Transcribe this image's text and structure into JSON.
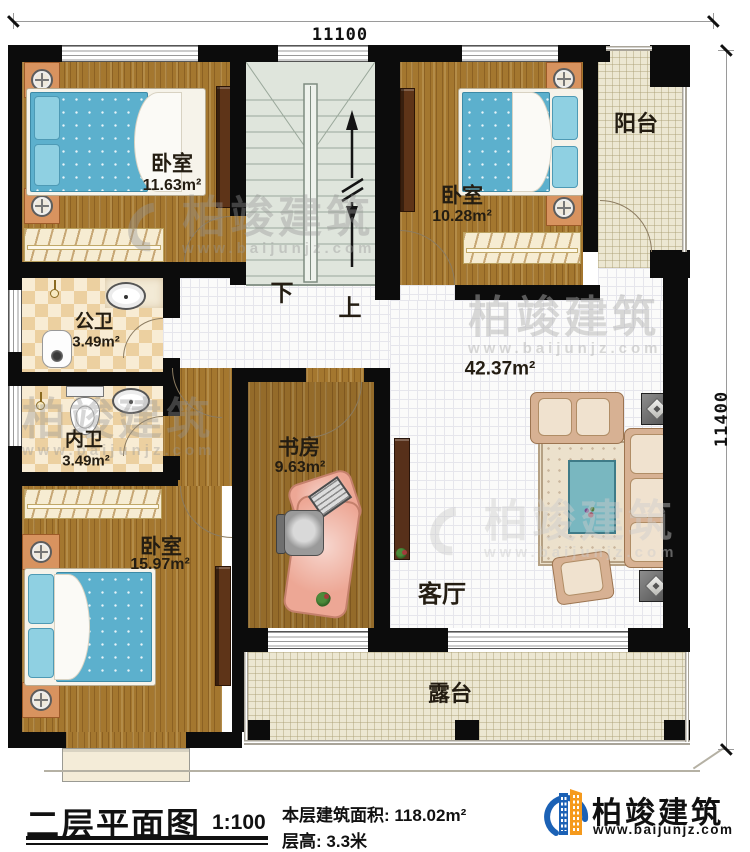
{
  "dimensions": {
    "width_label": "11100",
    "height_label": "11400"
  },
  "rooms": {
    "bedroom_top_left": {
      "name": "卧室",
      "area": "11.63m²"
    },
    "bedroom_top_right": {
      "name": "卧室",
      "area": "10.28m²"
    },
    "bedroom_bottom_left": {
      "name": "卧室",
      "area": "15.97m²"
    },
    "study": {
      "name": "书房",
      "area": "9.63m²"
    },
    "public_bathroom": {
      "name": "公卫",
      "area": "3.49m²"
    },
    "private_bathroom": {
      "name": "内卫",
      "area": "3.49m²"
    },
    "living_room": {
      "name": "客厅",
      "area": "42.37m²"
    },
    "balcony": {
      "name": "阳台"
    },
    "terrace": {
      "name": "露台"
    }
  },
  "stairs": {
    "down_label": "下",
    "up_label": "上"
  },
  "footer": {
    "title": "二层平面图",
    "scale": "1:100",
    "area_label": "本层建筑面积:",
    "area_value": "118.02m²",
    "floor_height_label": "层高:",
    "floor_height_value": "3.3米"
  },
  "brand": {
    "name": "柏竣建筑",
    "website": "www.baijunjz.com"
  },
  "watermark": {
    "name": "柏竣建筑",
    "website": "www.baijunjz.com"
  },
  "colors": {
    "wall": "#0c0c0c",
    "wood": "#a4772f",
    "tile_beige": "#ece7d2",
    "mattress": "#5cb0cd",
    "brand_blue": "#1b61b5",
    "brand_orange": "#f59a1d"
  }
}
